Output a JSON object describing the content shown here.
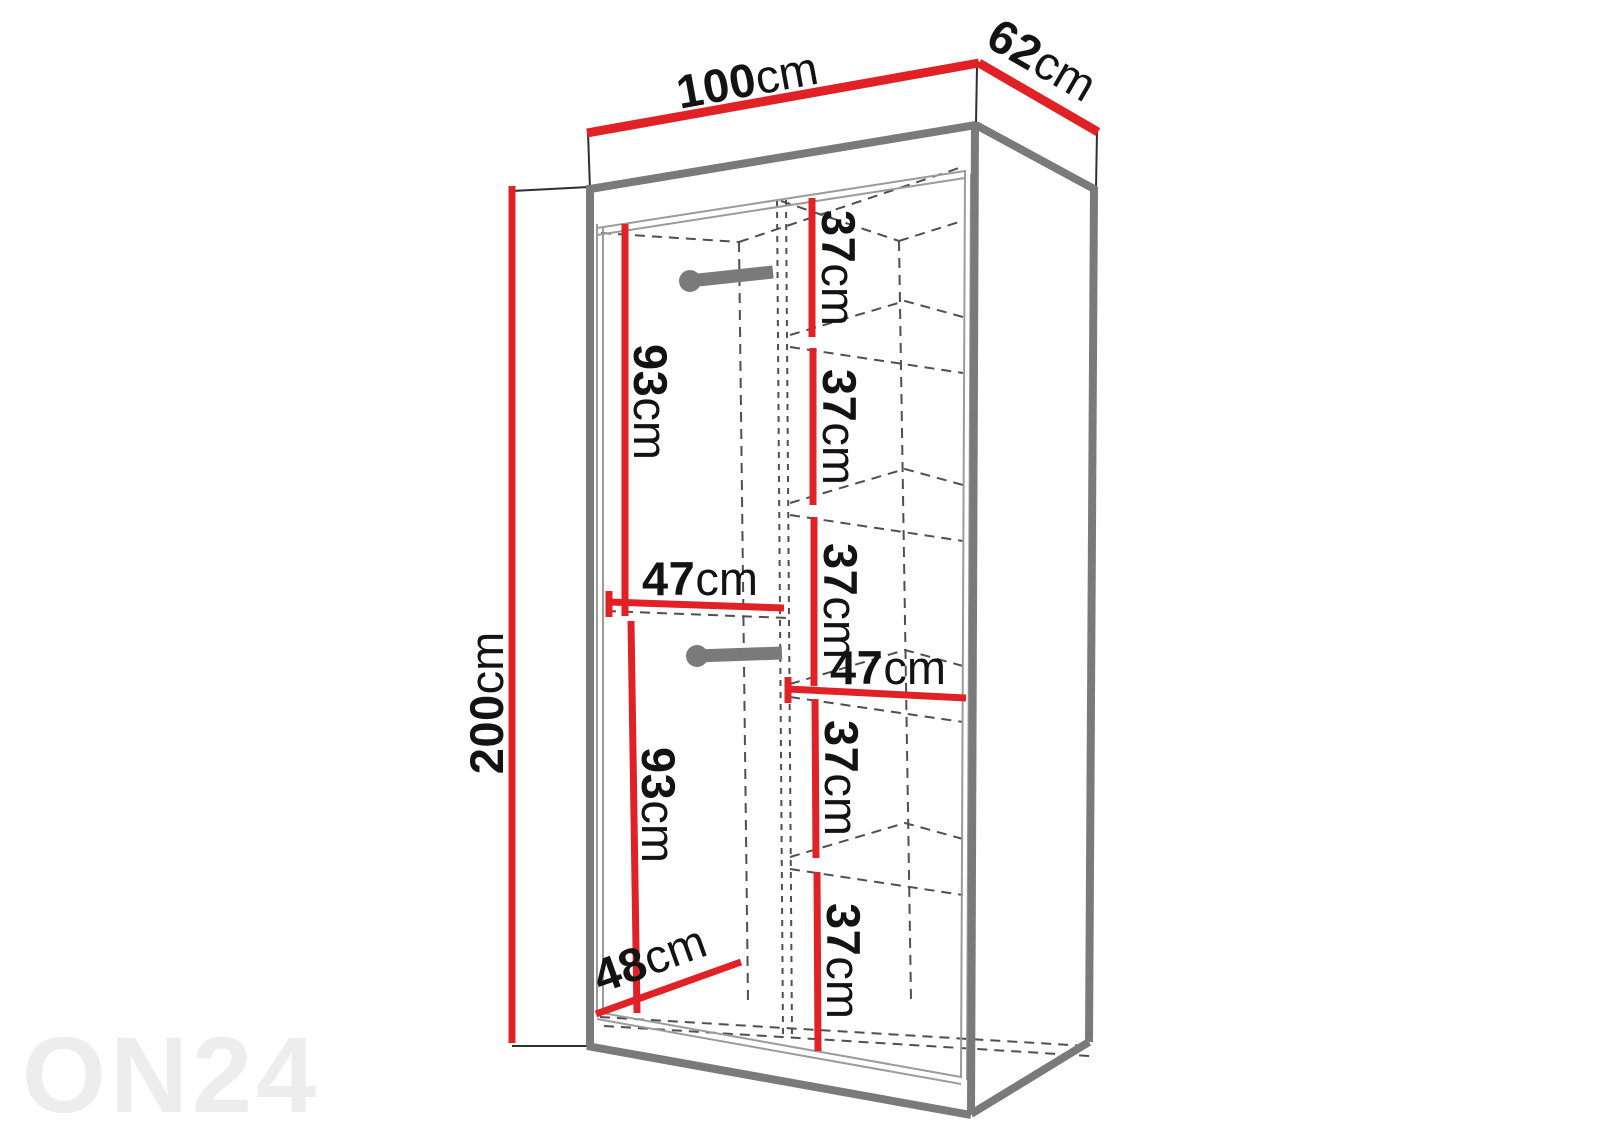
{
  "watermark": "ON24",
  "colors": {
    "dimension_red": "#e02227",
    "cabinet_gray": "#7a7a7a",
    "structure_gray": "#9b9b9b",
    "dashed_gray": "#4f4f4f",
    "outline_black": "#2f2f2f",
    "rail_gray": "#7a7a7a",
    "text_black": "#131313",
    "watermark_gray": "#ededed"
  },
  "dimensions": {
    "width": {
      "value": "100",
      "unit": "cm"
    },
    "depth_top": {
      "value": "62",
      "unit": "cm"
    },
    "height": {
      "value": "200",
      "unit": "cm"
    },
    "hanging_upper": {
      "value": "93",
      "unit": "cm"
    },
    "hanging_lower": {
      "value": "93",
      "unit": "cm"
    },
    "left_section_width": {
      "value": "47",
      "unit": "cm"
    },
    "right_section_width": {
      "value": "47",
      "unit": "cm"
    },
    "bottom_depth": {
      "value": "48",
      "unit": "cm"
    },
    "shelf_gaps": [
      {
        "value": "37",
        "unit": "cm"
      },
      {
        "value": "37",
        "unit": "cm"
      },
      {
        "value": "37",
        "unit": "cm"
      },
      {
        "value": "37",
        "unit": "cm"
      },
      {
        "value": "37",
        "unit": "cm"
      }
    ]
  }
}
